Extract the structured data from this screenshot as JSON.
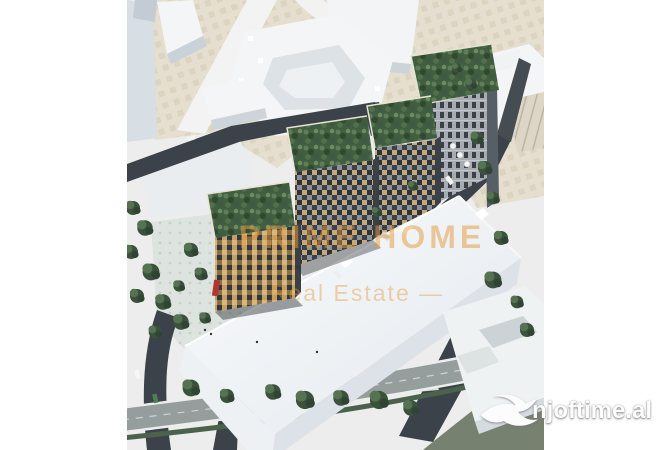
{
  "watermark": {
    "line1": "PRIME HOME",
    "line2": "Real Estate —"
  },
  "logo": {
    "text": "njoftime.al",
    "icon": "swallow-bird"
  },
  "palette": {
    "page_bg": "#ffffff",
    "scene_bg": "#ecedec",
    "terrain_beige": "#e6dfcf",
    "road_dark": "#3b4249",
    "road_light": "#959e9d",
    "tree_green": "#3a523c",
    "roof_green": "#415e42",
    "facade_tan": "#c5a97b",
    "facade_dark": "#2e3338",
    "building_white": "#f3f5f6",
    "watermark_orange": "#e49a3c",
    "logo_white": "#fcfcfc",
    "accent_red": "#b23630"
  }
}
